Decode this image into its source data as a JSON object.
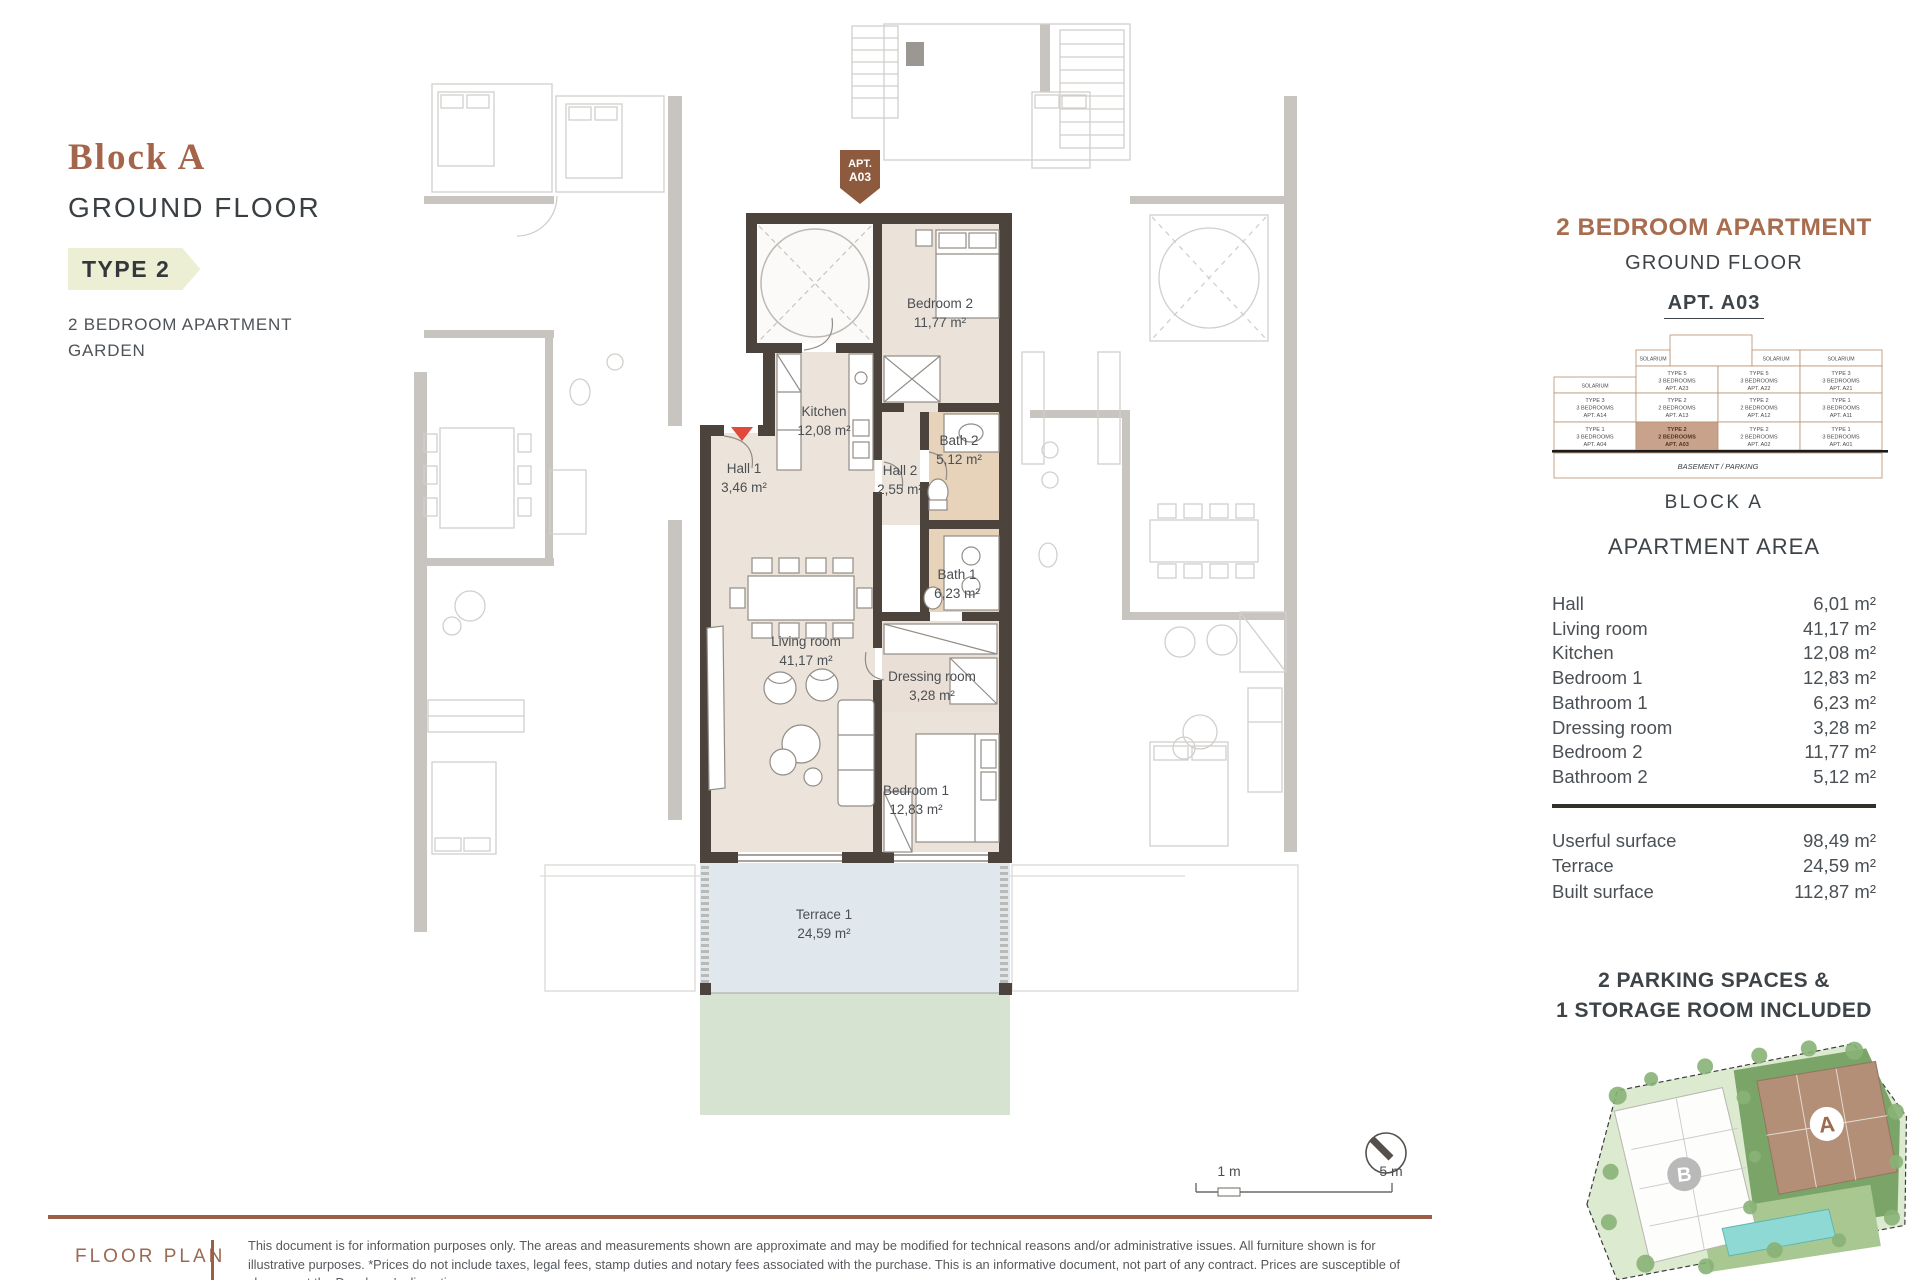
{
  "header": {
    "block": "Block A",
    "floor": "GROUND FLOOR",
    "type_badge": "TYPE 2",
    "sub1": "2 BEDROOM APARTMENT",
    "sub2": "GARDEN"
  },
  "plan": {
    "apt_tag": [
      "APT.",
      "A03"
    ],
    "rooms": {
      "bedroom2": {
        "name": "Bedroom 2",
        "area": "11,77 m²"
      },
      "kitchen": {
        "name": "Kitchen",
        "area": "12,08 m²"
      },
      "hall1": {
        "name": "Hall 1",
        "area": "3,46 m²"
      },
      "hall2": {
        "name": "Hall 2",
        "area": "2,55 m²"
      },
      "bath2": {
        "name": "Bath 2",
        "area": "5,12 m²"
      },
      "bath1": {
        "name": "Bath 1",
        "area": "6,23 m²"
      },
      "living": {
        "name": "Living room",
        "area": "41,17 m²"
      },
      "dressing": {
        "name": "Dressing room",
        "area": "3,28 m²"
      },
      "bedroom1": {
        "name": "Bedroom 1",
        "area": "12,83 m²"
      },
      "terrace": {
        "name": "Terrace 1",
        "area": "24,59 m²"
      }
    },
    "scale": {
      "left": "1 m",
      "right": "5 m"
    }
  },
  "sidebar": {
    "title": "2 BEDROOM APARTMENT",
    "subtitle": "GROUND FLOOR",
    "apt": "APT. A03",
    "stack": {
      "solarium": "SOLARIUM",
      "basement": "BASEMENT / PARKING",
      "rows": [
        [
          null,
          {
            "t": "TYPE 5",
            "b": "3 BEDROOMS",
            "a": "APT. A23"
          },
          {
            "t": "TYPE 5",
            "b": "3 BEDROOMS",
            "a": "APT. A22"
          },
          {
            "t": "TYPE 3",
            "b": "3 BEDROOMS",
            "a": "APT. A21"
          }
        ],
        [
          {
            "t": "TYPE 3",
            "b": "3 BEDROOMS",
            "a": "APT. A14"
          },
          {
            "t": "TYPE 2",
            "b": "2 BEDROOMS",
            "a": "APT. A13"
          },
          {
            "t": "TYPE 2",
            "b": "2 BEDROOMS",
            "a": "APT. A12"
          },
          {
            "t": "TYPE 1",
            "b": "3 BEDROOMS",
            "a": "APT. A11"
          }
        ],
        [
          {
            "t": "TYPE 1",
            "b": "3 BEDROOMS",
            "a": "APT. A04"
          },
          {
            "t": "TYPE 2",
            "b": "2 BEDROOMS",
            "a": "APT. A03",
            "highlight": true
          },
          {
            "t": "TYPE 2",
            "b": "2 BEDROOMS",
            "a": "APT. A02"
          },
          {
            "t": "TYPE 1",
            "b": "3 BEDROOMS",
            "a": "APT. A01"
          }
        ]
      ]
    },
    "block_label": "BLOCK A",
    "area_title": "APARTMENT AREA",
    "areas": [
      [
        "Hall",
        "6,01 m²"
      ],
      [
        "Living room",
        "41,17 m²"
      ],
      [
        "Kitchen",
        "12,08 m²"
      ],
      [
        "Bedroom 1",
        "12,83 m²"
      ],
      [
        "Bathroom 1",
        "6,23 m²"
      ],
      [
        "Dressing room",
        "3,28 m²"
      ],
      [
        "Bedroom 2",
        "11,77 m²"
      ],
      [
        "Bathroom 2",
        "5,12 m²"
      ]
    ],
    "totals": [
      [
        "Userful surface",
        "98,49 m²"
      ],
      [
        "Terrace",
        "24,59 m²"
      ],
      [
        "Built surface",
        "112,87 m²"
      ]
    ],
    "parking": [
      "2 PARKING SPACES &",
      "1 STORAGE ROOM INCLUDED"
    ]
  },
  "sitemap": {
    "block_a_label": "A",
    "block_b_label": "B"
  },
  "footer": {
    "label": "FLOOR PLAN",
    "disclaimer": "This document is for information purposes only. The areas and measurements shown are approximate and may be modified for technical reasons and/or administrative issues. All furniture shown is for illustrative purposes. *Prices do not include taxes, legal fees, stamp duties and notary fees associated with the purchase. This is an informative document, not part of any contract. Prices are susceptible of changes at the Developer's discretion."
  },
  "colors": {
    "accent_brown": "#a86c4e",
    "badge_bg": "#ecefd3",
    "wall": "#4c433d",
    "floor": "#ece4db",
    "bath_floor": "#e7d2ba",
    "terrace": "#e1e8ed",
    "garden": "#d6e3d1",
    "highlight_cell": "#c9a28c",
    "entry_red": "#e2493b",
    "footer_rule": "#9a5f44"
  }
}
